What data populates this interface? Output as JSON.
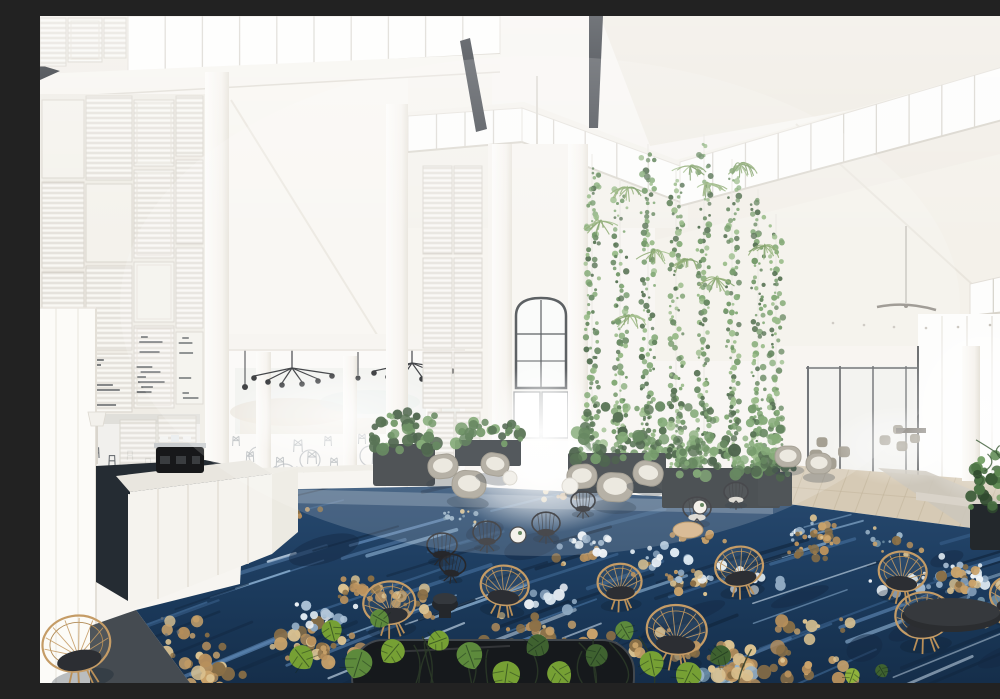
{
  "scene": {
    "type": "photograph",
    "description": "Bright white hotel lobby atrium with vaulted ceiling, black steel beams, clerestory windows, a louvered shutter feature wall, a coffee counter with espresso machine, a restaurant with cross-back chairs and black pendant chandeliers, a central arched doorway flooded with daylight, a two-storey hanging vine green wall, a navy blue carpet with gold and pale blue floral brushstrokes, rattan hoop chairs, black wire chairs, grey tub chairs, dark planter boxes and monstera foliage in the foreground",
    "setting": "hotel lobby atrium",
    "view": "elevated wide interior view"
  },
  "objects": {
    "louver_wall": "patchwork of white plantation shutter panels",
    "green_wall": "hanging ivy strands and spider plants on white trellis",
    "reception_counter": "white angled coffee counter with black espresso machine",
    "restaurant": "dining area with white cross-back chairs, round tables and black spider chandeliers",
    "right_hall": "timber floor corridor with glass walls and grey dining chairs",
    "carpet": "navy carpet with diagonal streaks and gold / ice-blue floral clusters",
    "ceiling": "white vaulted ceiling with two black steel beams and two ceiling fans",
    "seating_counts": {
      "grey_tub_chairs": 8,
      "black_wire_chairs": 7,
      "rattan_hoop_chairs": 10,
      "coffee_tables": 5,
      "planters": 6
    }
  },
  "palette": {
    "wall_white": "#f7f5f1",
    "ceiling_ivory": "#f0ece4",
    "beam_black": "#2a2f36",
    "carpet_navy": "#1b3a5c",
    "carpet_mid": "#3c648f",
    "carpet_light": "#8fb3d4",
    "carpet_pale": "#dde8f0",
    "carpet_gold": "#b8905c",
    "carpet_sand": "#dcc391",
    "carpet_dark": "#132942",
    "green_dark": "#3a5a36",
    "green_mid": "#4b7244",
    "green": "#5c8850",
    "green_light": "#6f9c60",
    "green_pale": "#88b075",
    "monstera_bright": "#8fb23c",
    "monstera_mid": "#5d8a3c",
    "monstera_dark": "#3f6230",
    "rattan": "#c59c66",
    "cushion_dark": "#2c2e33",
    "chair_grey": "#a9a396",
    "cushion_white": "#e9e5da",
    "wood_floor": "#d6cab5",
    "dark_floor": "#252c33",
    "planter_dark": "#2e3438",
    "wire_black": "#26272b"
  }
}
